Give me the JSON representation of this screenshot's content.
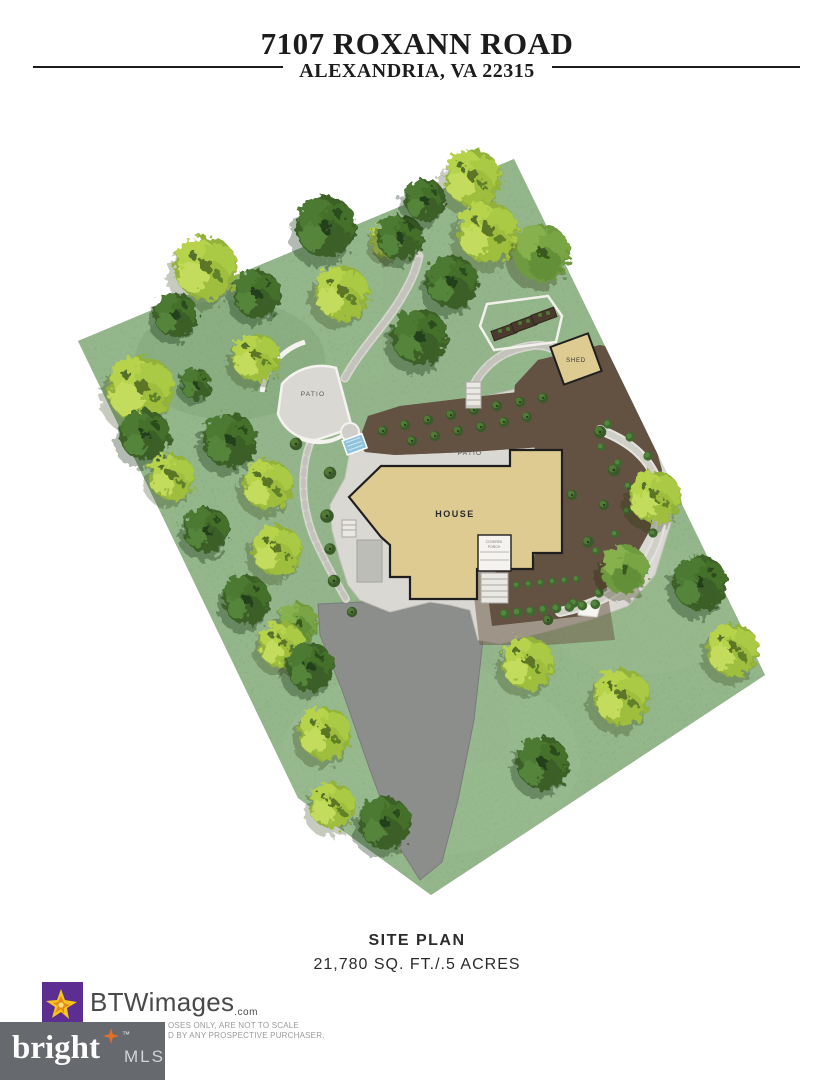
{
  "header": {
    "title": "7107 ROXANN ROAD",
    "subtitle": "ALEXANDRIA, VA 22315"
  },
  "plan": {
    "labels": {
      "house": "HOUSE",
      "patio_upper": "PATIO",
      "patio_fan": "PATIO",
      "shed": "SHED",
      "porch_line1": "COVERED",
      "porch_line2": "PORCH"
    },
    "colors": {
      "grass": "#7ca677",
      "tree_light": "#b7d24c",
      "tree_dark": "#3c6128",
      "mulch": "#554639",
      "stone": "#d9d8d2",
      "house": "#ddcb92",
      "outline": "#1f1f1f",
      "driveway": "#8c8e8c",
      "pool": "#8fc3dd"
    }
  },
  "footer": {
    "caption": "SITE PLAN",
    "area": "21,780 SQ. FT./.5 ACRES"
  },
  "branding": {
    "btw": {
      "name": "BTWimages",
      "tld": ".com",
      "purple": "#5c2e91",
      "yellow": "#f5c51a"
    },
    "bright": {
      "word": "bright",
      "tm": "™",
      "suffix": "MLS",
      "bg": "#66696d",
      "star": "#e2702a"
    },
    "disclaimer_line1": "OSES ONLY, ARE NOT TO SCALE",
    "disclaimer_line2": "D BY ANY PROSPECTIVE PURCHASER."
  }
}
